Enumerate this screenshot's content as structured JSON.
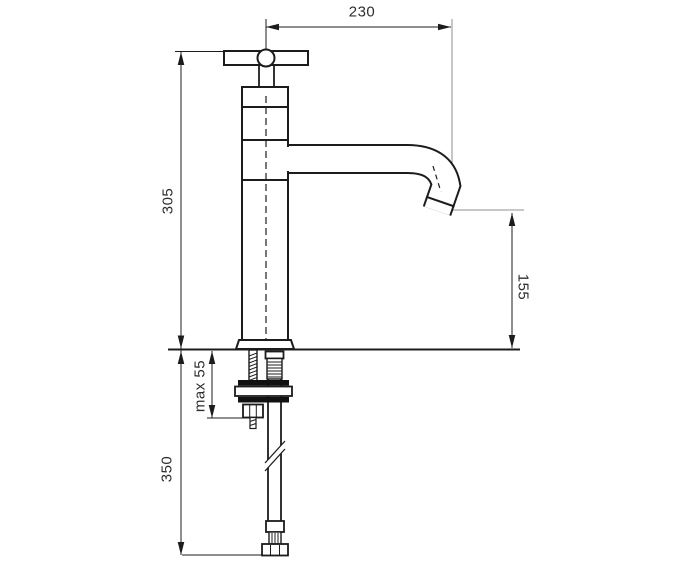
{
  "drawing": {
    "type": "technical-dimension-drawing",
    "subject": "single-hole basin tap with cross handle and flexible supply hose",
    "dimensions": {
      "spout_reach": "230",
      "total_height": "305",
      "spout_outlet_height": "155",
      "max_deck_thickness": "max 55",
      "hose_length": "350"
    },
    "colors": {
      "background": "#ffffff",
      "object_line": "#1c1c1c",
      "extension_line": "#8f8f8f",
      "text": "#2e2e2e"
    }
  }
}
